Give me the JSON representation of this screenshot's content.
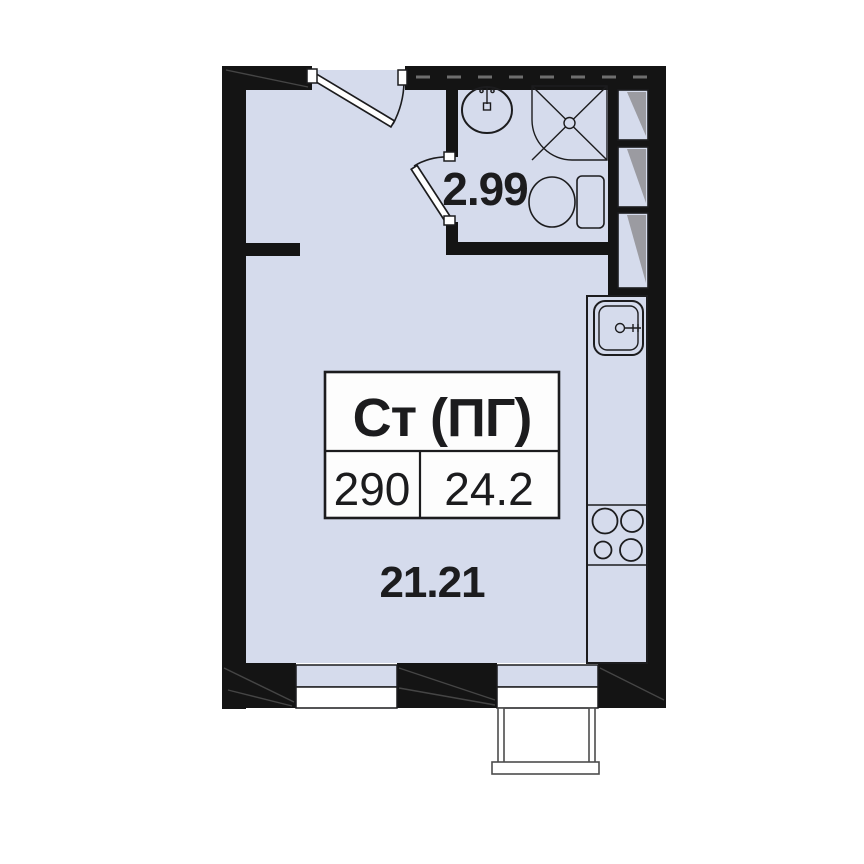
{
  "title": "Studio apartment floor plan",
  "unit_card": {
    "type_label": "Ст (ПГ)",
    "unit_number": "290",
    "total_area": "24.2"
  },
  "areas": {
    "bathroom": "2.99",
    "main_room": "21.21"
  },
  "fixtures": [
    "entrance-door",
    "bathroom-door",
    "bathroom-sink-icon",
    "shower-icon",
    "toilet-icon",
    "vent-shaft-icon",
    "kitchen-sink-icon",
    "stove-icon",
    "window",
    "balcony"
  ],
  "colors": {
    "floor": "#d5dbec",
    "wall": "#141414",
    "line": "#1c1c1e",
    "shade": "#9b9ba1",
    "paper": "#ffffff"
  }
}
